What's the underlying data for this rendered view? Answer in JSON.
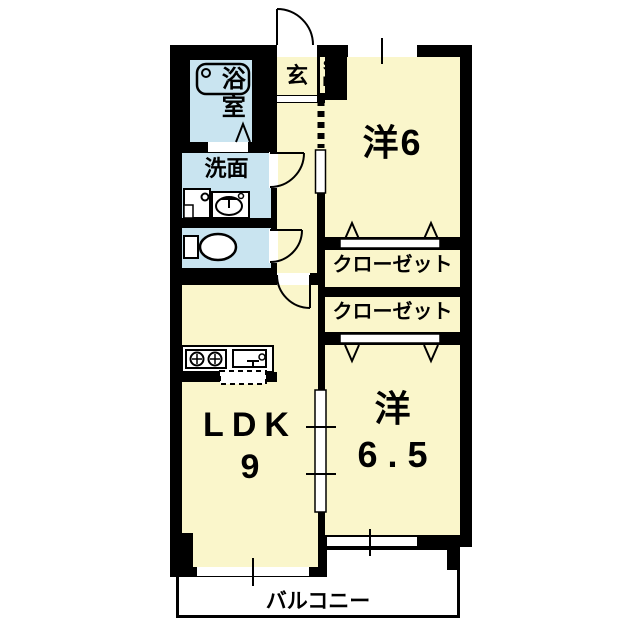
{
  "plan_title": "2LDK apartment floor plan",
  "colors": {
    "room_cream": "#FAF6CB",
    "wet_area_blue": "#C9E4F0",
    "wall_black": "#000000",
    "balcony_white": "#FFFFFF"
  },
  "rooms": {
    "bath": {
      "label": "浴室"
    },
    "washroom": {
      "label": "洗面"
    },
    "entrance": {
      "label": "玄"
    },
    "shoe_box": {
      "line1": "S",
      "line2": "B"
    },
    "western6": {
      "label": "洋6"
    },
    "closet1": {
      "label": "クローゼット"
    },
    "closet2": {
      "label": "クローゼット"
    },
    "ldk": {
      "line1": "LDK",
      "line2": "9"
    },
    "western65": {
      "line1": "洋",
      "line2": "6.5"
    },
    "balcony": {
      "label": "バルコニー"
    }
  },
  "icons": {
    "bathtub": "bathtub-icon",
    "bath_folding_door": "folding-door-icon",
    "washing_machine_pan": "washing-machine-pan-icon",
    "wash_basin": "wash-basin-icon",
    "toilet": "toilet-icon",
    "stove_burners": "stove-burners-icon",
    "kitchen_sink": "kitchen-sink-icon",
    "entrance_door_arc": "door-swing-icon",
    "closet_folding_doors": "folding-door-triangles-icon",
    "window_tick": "window-mullion-icon"
  }
}
